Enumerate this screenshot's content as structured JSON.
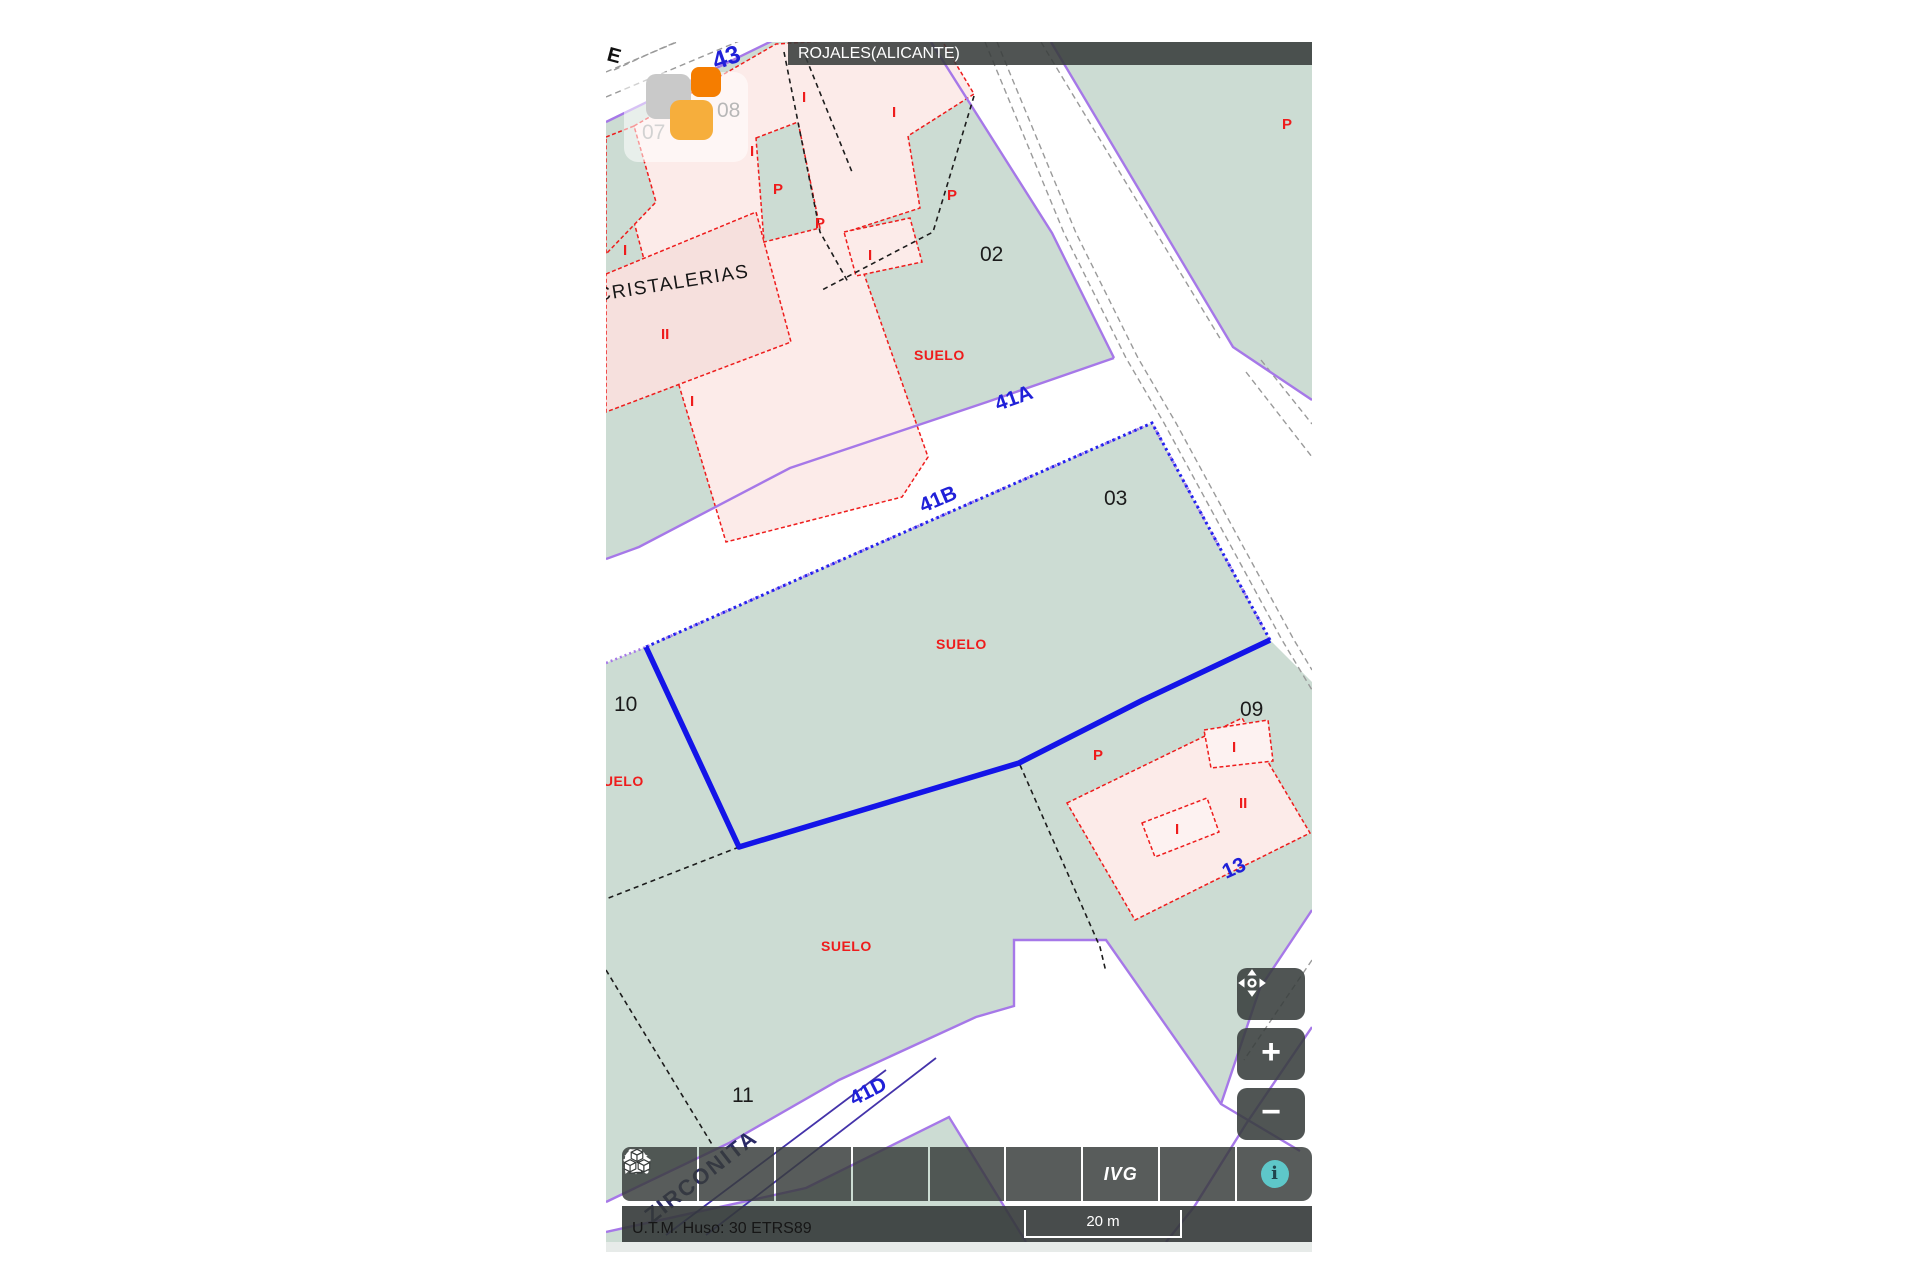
{
  "map": {
    "municipality": "ROJALES(ALICANTE)",
    "street_labels": {
      "l43": "43",
      "l41a": "41A",
      "l41b": "41B",
      "l41d": "41D",
      "l13": "13",
      "zirconita": "ZIRCONITA",
      "e": "E"
    },
    "parcel_numbers": {
      "n02": "02",
      "n03": "03",
      "n07": "07",
      "n08": "08",
      "n09": "09",
      "n10": "10",
      "n11": "11"
    },
    "land_labels": {
      "suelo": "SUELO",
      "cristalerias": "CRISTALERIAS"
    },
    "construction_marks": {
      "i": "I",
      "ii": "II",
      "p": "P"
    },
    "colors": {
      "parcel_green": "#ccdcd3",
      "building_pink": "#fcebe9",
      "building_pink_dark": "#f6e0dd",
      "boundary_purple": "#a678e8",
      "selection_blue": "#1414e8",
      "label_red": "#ee1c1c",
      "street_blue": "#2020d8",
      "toolbar_dark": "#383d3c",
      "info_teal": "#5ec7c9",
      "marker_orange": "#f57d00",
      "marker_amber": "#f6ae3c",
      "marker_gray": "#c9c9c9"
    }
  },
  "toolbar": {
    "ivg_label": "IVG",
    "p_label": "P",
    "info_glyph": "i"
  },
  "zoom_controls": {
    "zoom_in": "+",
    "zoom_out": "−"
  },
  "status_bar": {
    "crs": "U.T.M. Huso: 30 ETRS89",
    "scale_label": "20 m"
  }
}
